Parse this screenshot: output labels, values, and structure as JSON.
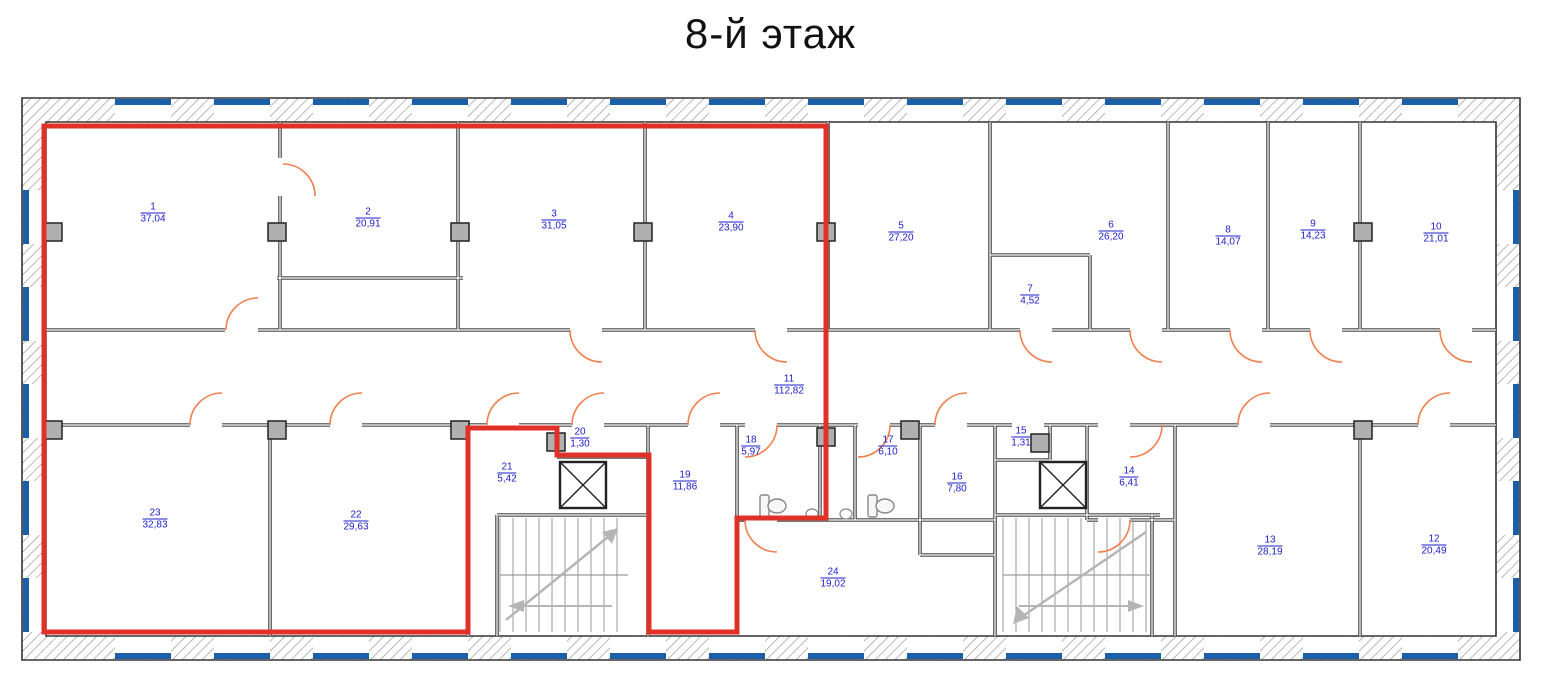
{
  "title": "8-й этаж",
  "colors": {
    "highlight_red": "#e03127",
    "label_blue": "#1d1dc8",
    "window_blue": "#1a5fa8",
    "door_orange": "#f08050",
    "wall_dark": "#4a4a4a"
  },
  "highlighted_room_numbers": [
    "1",
    "2",
    "3",
    "4",
    "11",
    "19",
    "21",
    "22",
    "23"
  ],
  "rooms": [
    {
      "number": "1",
      "area": "37,04",
      "x": 153,
      "y": 213,
      "highlighted": true
    },
    {
      "number": "2",
      "area": "20,91",
      "x": 368,
      "y": 218,
      "highlighted": true
    },
    {
      "number": "3",
      "area": "31,05",
      "x": 554,
      "y": 220,
      "highlighted": true
    },
    {
      "number": "4",
      "area": "23,90",
      "x": 731,
      "y": 222,
      "highlighted": true
    },
    {
      "number": "5",
      "area": "27,20",
      "x": 901,
      "y": 232,
      "highlighted": false
    },
    {
      "number": "6",
      "area": "26,20",
      "x": 1111,
      "y": 231,
      "highlighted": false
    },
    {
      "number": "7",
      "area": "4,52",
      "x": 1030,
      "y": 295,
      "highlighted": false
    },
    {
      "number": "8",
      "area": "14,07",
      "x": 1228,
      "y": 236,
      "highlighted": false
    },
    {
      "number": "9",
      "area": "14,23",
      "x": 1313,
      "y": 230,
      "highlighted": false
    },
    {
      "number": "10",
      "area": "21,01",
      "x": 1436,
      "y": 233,
      "highlighted": false
    },
    {
      "number": "11",
      "area": "112,82",
      "x": 789,
      "y": 385,
      "highlighted": true
    },
    {
      "number": "12",
      "area": "20,49",
      "x": 1434,
      "y": 545,
      "highlighted": false
    },
    {
      "number": "13",
      "area": "28,19",
      "x": 1270,
      "y": 546,
      "highlighted": false
    },
    {
      "number": "14",
      "area": "6,41",
      "x": 1129,
      "y": 477,
      "highlighted": false
    },
    {
      "number": "15",
      "area": "1,31",
      "x": 1021,
      "y": 437,
      "highlighted": false
    },
    {
      "number": "16",
      "area": "7,80",
      "x": 957,
      "y": 483,
      "highlighted": false
    },
    {
      "number": "17",
      "area": "6,10",
      "x": 888,
      "y": 446,
      "highlighted": false
    },
    {
      "number": "18",
      "area": "5,97",
      "x": 751,
      "y": 446,
      "highlighted": false
    },
    {
      "number": "19",
      "area": "11,86",
      "x": 685,
      "y": 481,
      "highlighted": true
    },
    {
      "number": "20",
      "area": "1,30",
      "x": 580,
      "y": 438,
      "highlighted": false
    },
    {
      "number": "21",
      "area": "5,42",
      "x": 507,
      "y": 473,
      "highlighted": true
    },
    {
      "number": "22",
      "area": "29,63",
      "x": 356,
      "y": 521,
      "highlighted": true
    },
    {
      "number": "23",
      "area": "32,83",
      "x": 155,
      "y": 519,
      "highlighted": true
    },
    {
      "number": "24",
      "area": "19,02",
      "x": 833,
      "y": 578,
      "highlighted": false
    }
  ]
}
